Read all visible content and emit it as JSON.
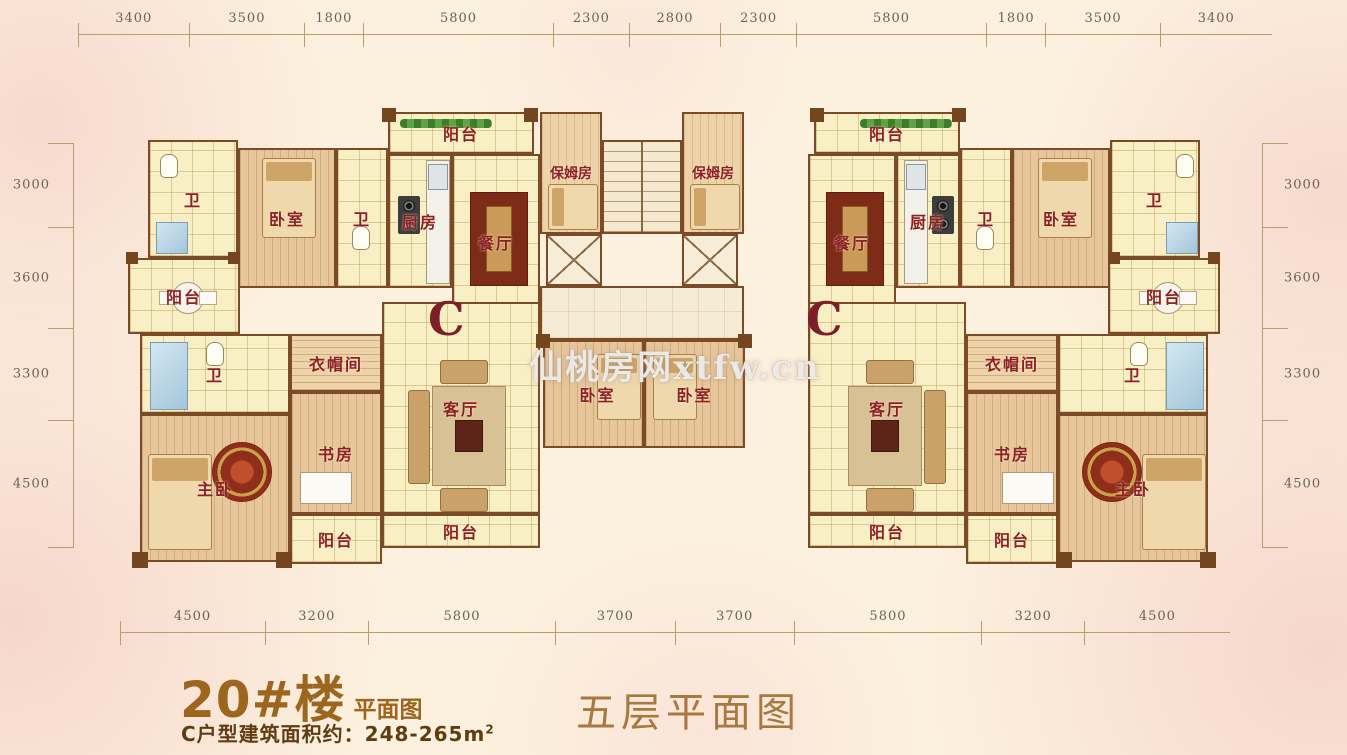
{
  "unit_label": "C",
  "watermark": "仙桃房网xtfw.cn",
  "dimensions": {
    "top": [
      "3400",
      "3500",
      "1800",
      "5800",
      "2300",
      "2800",
      "2300",
      "5800",
      "1800",
      "3500",
      "3400"
    ],
    "bottom": [
      "4500",
      "3200",
      "5800",
      "3700",
      "3700",
      "5800",
      "3200",
      "4500"
    ],
    "left": [
      "3000",
      "3600",
      "3300",
      "4500"
    ],
    "right": [
      "3000",
      "3600",
      "3300",
      "4500"
    ]
  },
  "rooms": {
    "bath": "卫",
    "bedroom": "卧室",
    "kitchen": "厨房",
    "dining": "餐厅",
    "nanny_room": "保姆房",
    "balcony": "阳台",
    "cloakroom": "衣帽间",
    "study": "书房",
    "living": "客厅",
    "master_bedroom": "主卧"
  },
  "footer": {
    "building_title": "20#楼",
    "building_suffix": "平面图",
    "area_text": "C户型建筑面积约：248-265m",
    "area_sup": "2",
    "floor_title": "五层平面图"
  },
  "colors": {
    "background": "#fcf1de",
    "pattern_pink": "#f6d5cb",
    "room_label": "#8c2125",
    "unit_letter": "#7d1f26",
    "wall": "#7b4a26",
    "tile_floor": "#f8efc5",
    "wood_floor": "#e7c69b",
    "dimension_text": "#6b6258",
    "title_brown": "#9c661f",
    "subtitle_brown": "#5f3d11",
    "floor_title_brown": "#a9783e"
  }
}
